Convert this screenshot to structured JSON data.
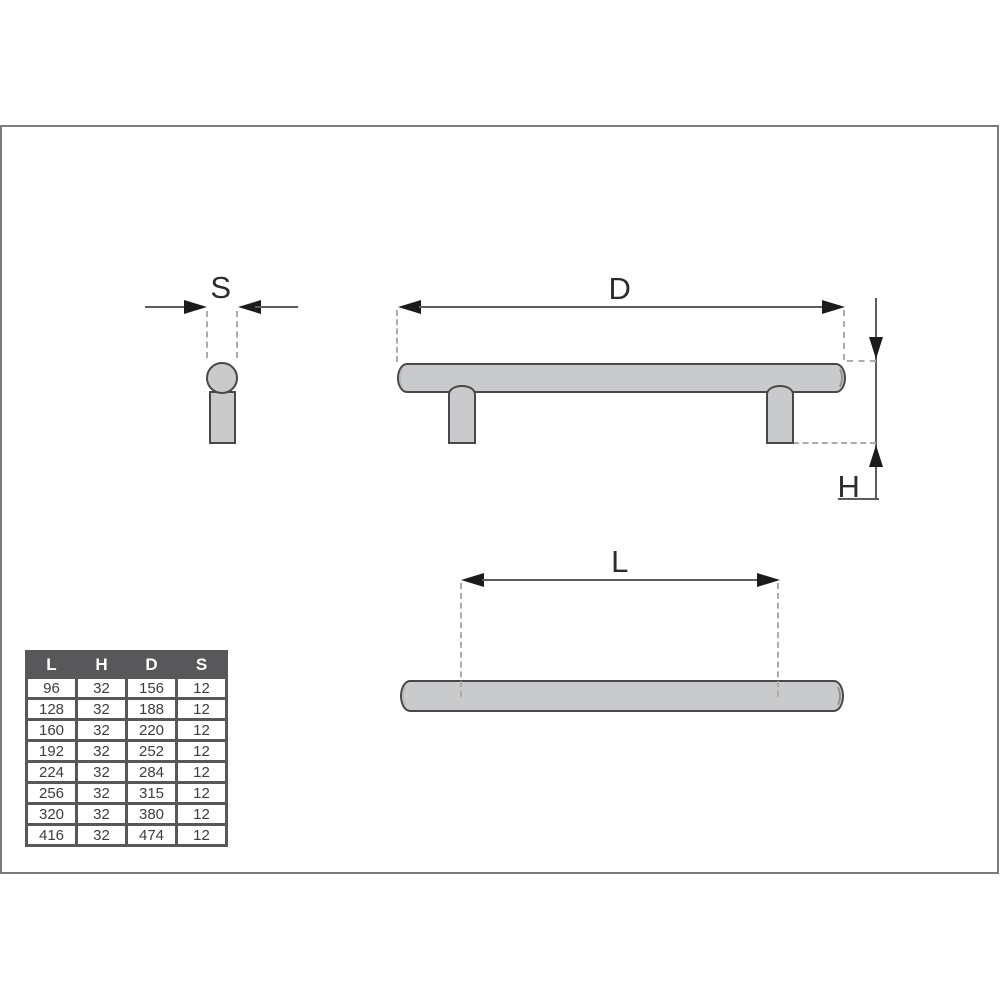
{
  "diagram": {
    "side_view": {
      "label": "S"
    },
    "front_view": {
      "label": "D"
    },
    "height_dim": {
      "label": "H"
    },
    "top_view": {
      "label": "L"
    },
    "colors": {
      "part_fill": "#c9cacb",
      "part_outline": "#48484a",
      "dimension_line": "#5d5d5d",
      "arrowhead": "#1b1b1b",
      "extension_dash": "#ababab",
      "frame_border": "#7c7c7c"
    }
  },
  "table": {
    "headers": [
      "L",
      "H",
      "D",
      "S"
    ],
    "rows": [
      [
        "96",
        "32",
        "156",
        "12"
      ],
      [
        "128",
        "32",
        "188",
        "12"
      ],
      [
        "160",
        "32",
        "220",
        "12"
      ],
      [
        "192",
        "32",
        "252",
        "12"
      ],
      [
        "224",
        "32",
        "284",
        "12"
      ],
      [
        "256",
        "32",
        "315",
        "12"
      ],
      [
        "320",
        "32",
        "380",
        "12"
      ],
      [
        "416",
        "32",
        "474",
        "12"
      ]
    ],
    "header_bg": "#58585a",
    "header_text_color": "#ffffff",
    "cell_text_color": "#3d3d3f"
  }
}
